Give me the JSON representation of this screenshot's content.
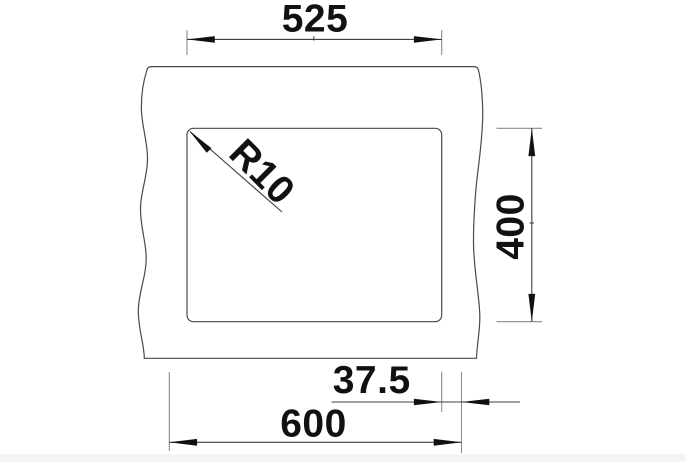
{
  "page": {
    "background": "#ffffff",
    "footer_strip_color": "#f4f4f4"
  },
  "drawing": {
    "type": "technical-dimension-drawing",
    "subject": "sink-cutout-plan-view",
    "colors": {
      "outline": "#4a4a4a",
      "dimension_line": "#3f3f3f",
      "extension_line": "#8c8c8c",
      "arrow": "#111111",
      "text": "#111111"
    },
    "dimensions": {
      "cutout_width": {
        "label": "525",
        "value": 525
      },
      "cutout_height": {
        "label": "400",
        "value": 400
      },
      "overall_width": {
        "label": "600",
        "value": 600
      },
      "side_margin": {
        "label": "37.5",
        "value": 37.5
      },
      "corner_radius": {
        "label": "R10",
        "value": 10
      }
    }
  }
}
